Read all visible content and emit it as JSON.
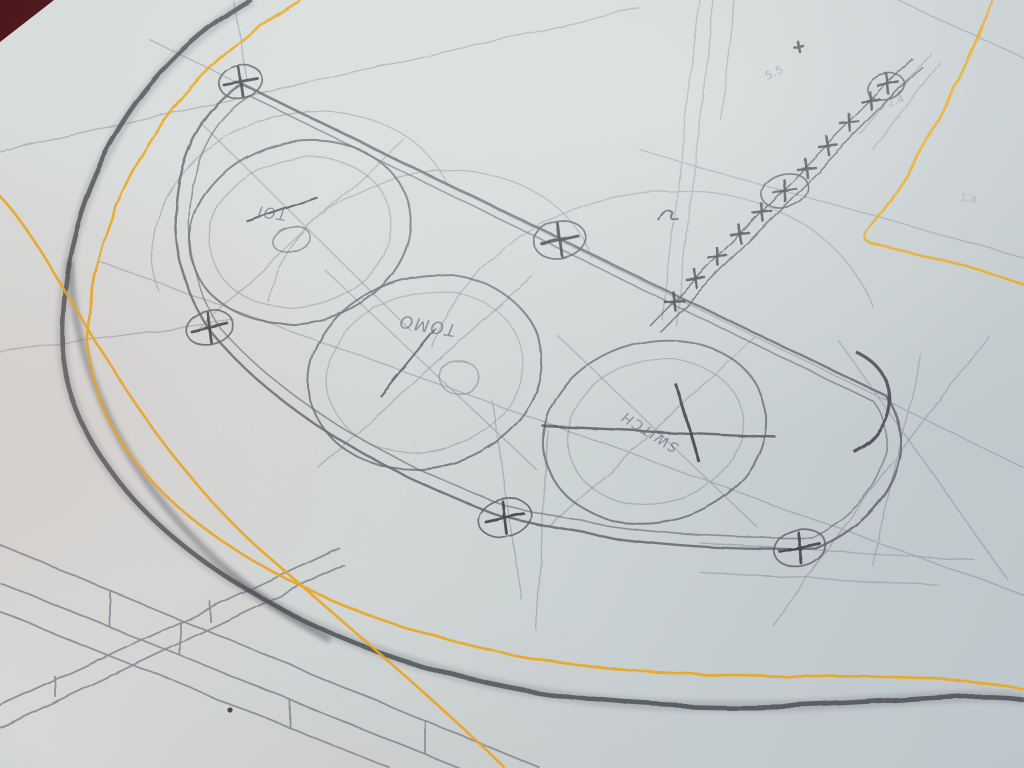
{
  "colors": {
    "paper": "#d5dbda",
    "desk": "#4a1518",
    "pencil_dark": "#4c4f56",
    "pencil": "#60666f",
    "pencil_faint": "#8a909c",
    "accent_yellow": "#eda71d"
  },
  "annotations": {
    "gauge1": "TOI",
    "gauge2": "TOMO",
    "gauge3": "SWITCH",
    "measure1": "5.5",
    "measure2": "2.4",
    "measure3": "1.4"
  }
}
